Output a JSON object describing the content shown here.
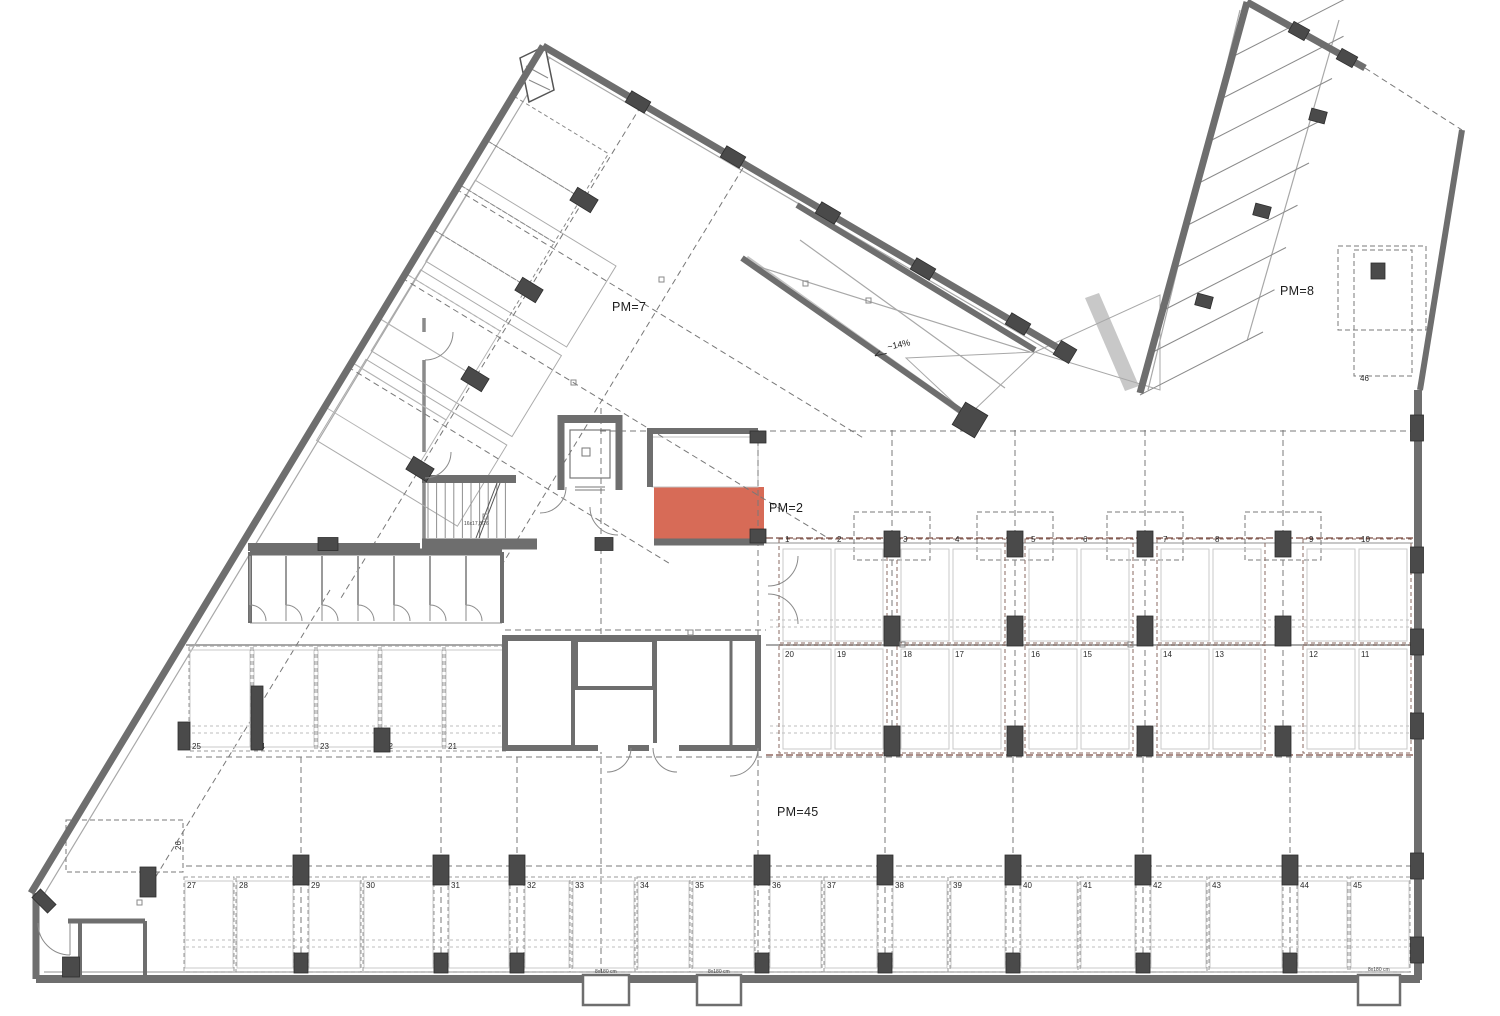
{
  "drawing": {
    "zone_labels": {
      "pm7": "PM=7",
      "pm8": "PM=8",
      "pm2": "PM=2",
      "pm45": "PM=45"
    },
    "ramp_slope_label": "~14%",
    "stair_label": "16x17,8/26",
    "shaft_label": "8x180 cm",
    "stalls": {
      "row_top": [
        "1",
        "2",
        "3",
        "4",
        "5",
        "6",
        "7",
        "8",
        "9",
        "10"
      ],
      "row_mid": [
        "20",
        "19",
        "18",
        "17",
        "16",
        "15",
        "14",
        "13",
        "12",
        "11"
      ],
      "row_left": [
        "25",
        "24",
        "23",
        "22",
        "21"
      ],
      "row_bottom": [
        "27",
        "28",
        "29",
        "30",
        "31",
        "32",
        "33",
        "34",
        "35",
        "36",
        "37",
        "38",
        "39",
        "40",
        "41",
        "42",
        "43",
        "44",
        "45"
      ],
      "corner_stall": "26",
      "single_stall": "46"
    },
    "highlight": {
      "color": "#d25740",
      "space_label": "PM=2"
    },
    "colors": {
      "wall": "#6e6e6e",
      "column": "#4a4a4a",
      "car": "#b9b9b9",
      "car_on_red": "#d8d0cc",
      "dash": "#787878",
      "maroon": "#7a4a40",
      "thin": "#a8a8a8",
      "light_dash": "#bdbdbd"
    }
  }
}
